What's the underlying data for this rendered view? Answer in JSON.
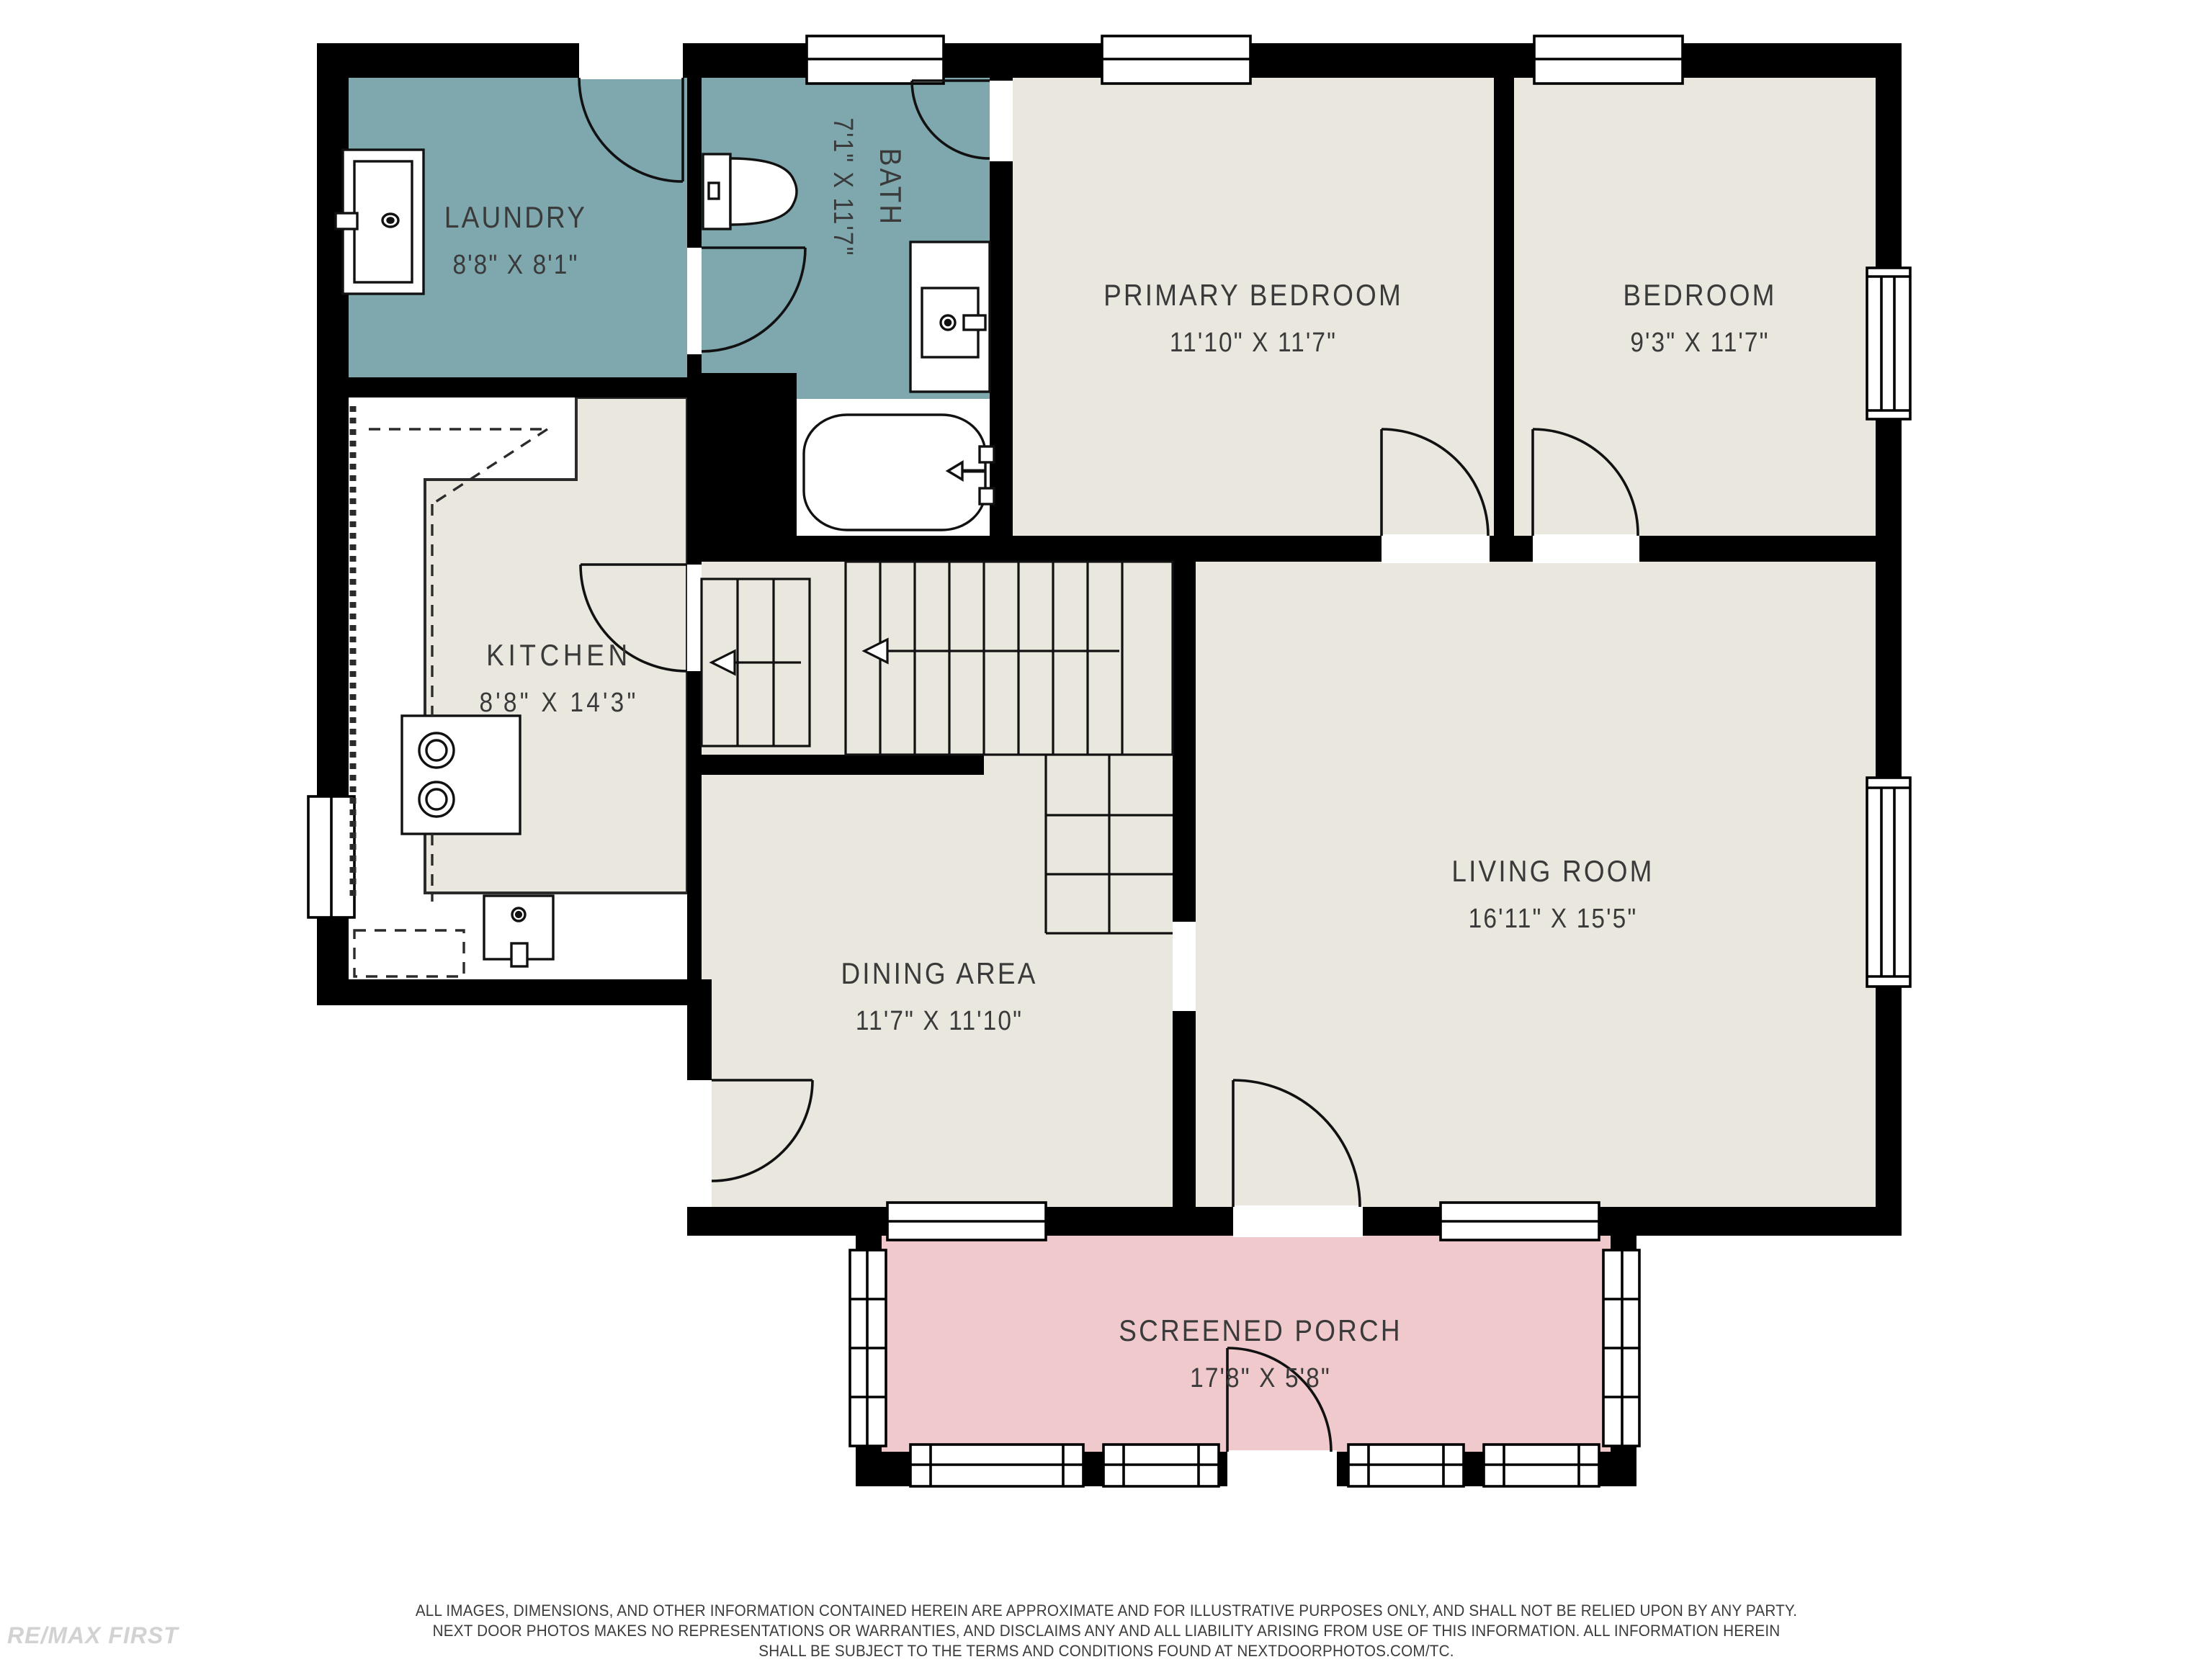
{
  "plan_type": "floor-plan",
  "rooms": [
    {
      "id": "laundry",
      "name": "LAUNDRY",
      "dims": "8'8\" X 8'1\"",
      "floor_color": "#7ea8ae"
    },
    {
      "id": "bath",
      "name": "BATH",
      "dims": "7'1\" X 11'7\"",
      "floor_color": "#7ea8ae"
    },
    {
      "id": "primary-bedroom",
      "name": "PRIMARY BEDROOM",
      "dims": "11'10\" X 11'7\"",
      "floor_color": "#e9e7de"
    },
    {
      "id": "bedroom",
      "name": "BEDROOM",
      "dims": "9'3\" X 11'7\"",
      "floor_color": "#e9e7de"
    },
    {
      "id": "kitchen",
      "name": "KITCHEN",
      "dims": "8'8\" X 14'3\"",
      "floor_color": "#e9e7de"
    },
    {
      "id": "dining-area",
      "name": "DINING AREA",
      "dims": "11'7\" X 11'10\"",
      "floor_color": "#e9e7de"
    },
    {
      "id": "living-room",
      "name": "LIVING ROOM",
      "dims": "16'11\" X 15'5\"",
      "floor_color": "#e9e7de"
    },
    {
      "id": "screened-porch",
      "name": "SCREENED PORCH",
      "dims": "17'8\" X 5'8\"",
      "floor_color": "#f0c9cc"
    }
  ],
  "fixtures": [
    "laundry-sink",
    "toilet",
    "vanity-sink",
    "bathtub",
    "stove",
    "kitchen-sink",
    "stairs-up-arrow"
  ],
  "colors": {
    "wall": "#000000",
    "wet_room_floor": "#7ea8ae",
    "main_floor": "#e9e7de",
    "porch_floor": "#f0c9cc",
    "label_text": "#3a3a3a",
    "disclaimer_text": "#3c3c3c",
    "watermark_text": "#d2d2d2"
  },
  "disclaimer": {
    "line1": "ALL IMAGES, DIMENSIONS, AND OTHER INFORMATION CONTAINED HEREIN ARE APPROXIMATE AND FOR ILLUSTRATIVE PURPOSES ONLY, AND SHALL NOT BE RELIED UPON BY ANY PARTY.",
    "line2": "NEXT DOOR PHOTOS MAKES NO REPRESENTATIONS OR WARRANTIES, AND DISCLAIMS ANY AND ALL LIABILITY ARISING FROM USE OF THIS INFORMATION. ALL INFORMATION HEREIN",
    "line3": "SHALL BE SUBJECT TO THE TERMS AND CONDITIONS FOUND AT NEXTDOORPHOTOS.COM/TC."
  },
  "watermark": "RE/MAX FIRST"
}
